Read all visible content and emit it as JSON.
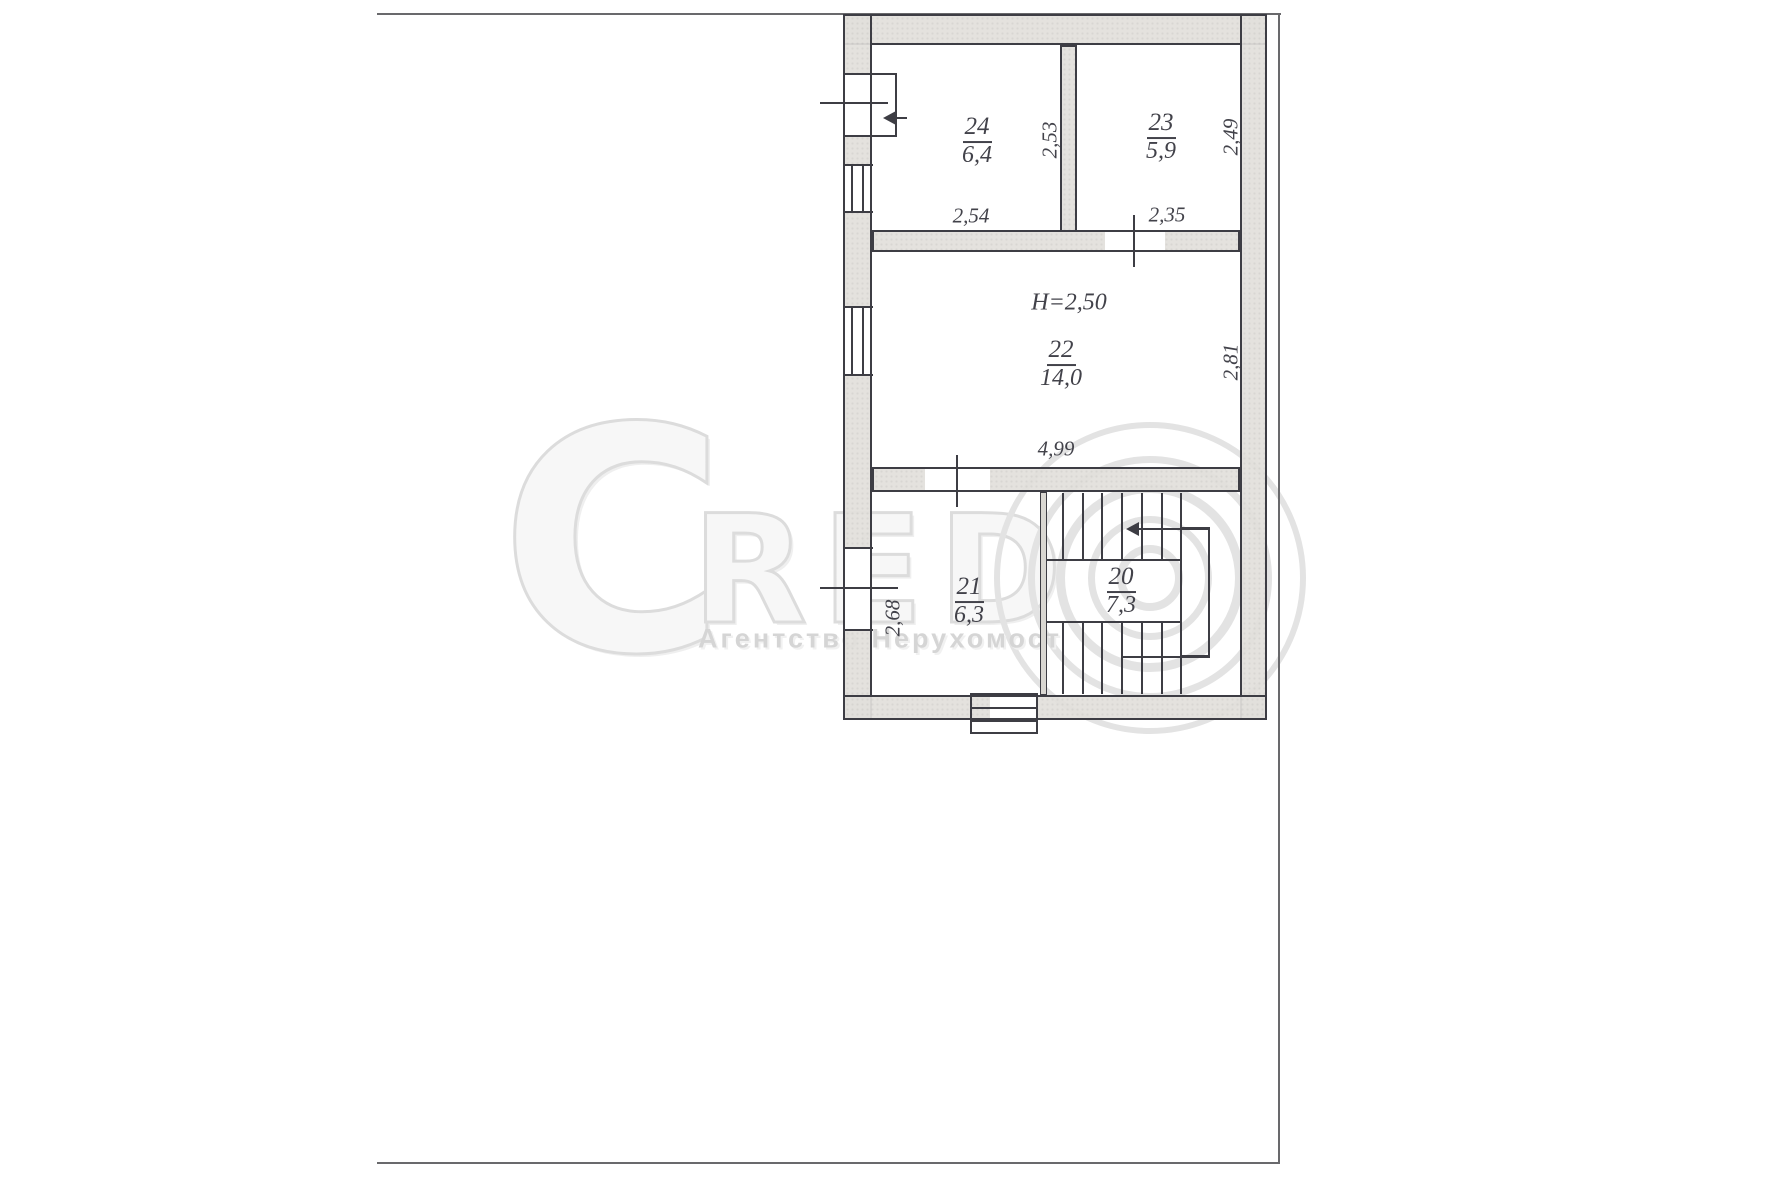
{
  "colors": {
    "paper": "#ffffff",
    "ink": "#3d3d44",
    "page_frame": "#69696c",
    "wall_fill": "#e2e0db",
    "watermark": "#dcdcdc"
  },
  "watermark": {
    "letter_c": "C",
    "letters_red": "RED",
    "logo_o": "copyright-rings",
    "agency_text": "Агентство Нерухомост"
  },
  "floor_plan": {
    "height_note": "H=2,50",
    "rooms": [
      {
        "number": "24",
        "area": "6,4",
        "width_dim": "2,54",
        "depth_dim": "2,53"
      },
      {
        "number": "23",
        "area": "5,9",
        "width_dim": "2,35",
        "depth_dim": "2,49"
      },
      {
        "number": "22",
        "area": "14,0",
        "width_dim": "4,99",
        "depth_dim": "2,81"
      },
      {
        "number": "21",
        "area": "6,3",
        "side_dim": "2,68"
      },
      {
        "number": "20",
        "area": "7,3"
      }
    ]
  }
}
